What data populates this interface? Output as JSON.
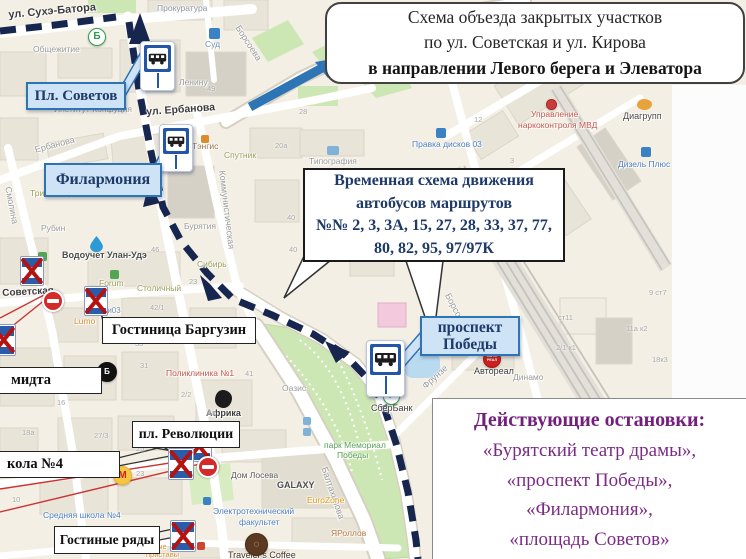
{
  "colors": {
    "route_navy": "#17264f",
    "detour_arrow_blue": "#2e75b6",
    "callout_blue_bg": "#cfe3f6",
    "callout_blue_border": "#2e74b5",
    "navy_text": "#1e3a68",
    "purple_text": "#7b2b85",
    "closed_x_red": "#b51212",
    "no_entry_red": "#d42a2a",
    "map_bg": "#f3efe4",
    "park_green": "#cde7b4"
  },
  "title_box": {
    "line1": "Схема объезда закрытых участков",
    "line2": "по ул. Советская и ул. Кирова",
    "line3": "в направлении Левого берега и Элеватора"
  },
  "routes_box": {
    "line1": "Временная схема движения",
    "line2": "автобусов маршрутов",
    "line3": "№№ 2, 3, 3А, 15, 27, 28, 33, 37, 77,",
    "line4": "80, 82, 95, 97/97К"
  },
  "active_stops_box": {
    "title": "Действующие остановки:",
    "items": [
      "«Бурятский театр драмы»,",
      "«проспект Победы»,",
      "«Филармония»,",
      "«площадь Советов»"
    ]
  },
  "stop_callouts": {
    "pl_sovetov": "Пл. Советов",
    "filarmonia": "Филармония",
    "pobedy_line1": "проспект",
    "pobedy_line2": "Победы"
  },
  "white_callouts": {
    "hotel": "Гостиница Баргузин",
    "revolution": "пл. Революции",
    "rows": "Гостиные ряды",
    "school": "кола №4",
    "shmidt": "мидта"
  },
  "map": {
    "streets": [
      {
        "t": "ул. Сухэ-Батора",
        "x": 8,
        "y": 10,
        "s": 11,
        "c": "#3c3c3c",
        "r": -5,
        "b": 1
      },
      {
        "t": "ул. Ербанова",
        "x": 146,
        "y": 107,
        "s": 10.5,
        "c": "#3c3c3c",
        "r": -4,
        "b": 1
      },
      {
        "t": "Ербанова",
        "x": 34,
        "y": 146,
        "s": 9,
        "c": "#9b9b9b",
        "r": -15,
        "b": 0
      },
      {
        "t": "Советская",
        "x": 2,
        "y": 289,
        "s": 10,
        "c": "#3c3c3c",
        "r": -3,
        "b": 1
      },
      {
        "t": "Смолина",
        "x": 12,
        "y": 186,
        "s": 9,
        "c": "#9b9b9b",
        "r": 79,
        "b": 0
      },
      {
        "t": "Коммунистическая",
        "x": 226,
        "y": 170,
        "s": 9,
        "c": "#9b9b9b",
        "r": 83,
        "b": 0
      },
      {
        "t": "Борсоева",
        "x": 241,
        "y": 24,
        "s": 9,
        "c": "#9b9b9b",
        "r": 57,
        "b": 0
      },
      {
        "t": "Борсоева",
        "x": 451,
        "y": 292,
        "s": 9,
        "c": "#9b9b9b",
        "r": 62,
        "b": 0
      },
      {
        "t": "Фрунзе",
        "x": 421,
        "y": 384,
        "s": 9,
        "c": "#9b9b9b",
        "r": -42,
        "b": 0
      },
      {
        "t": "Балтахинова",
        "x": 328,
        "y": 466,
        "s": 9,
        "c": "#9b9b9b",
        "r": 71,
        "b": 0
      }
    ],
    "pois": [
      {
        "t": "Прокуратура",
        "x": 157,
        "y": 4,
        "s": 8.5,
        "c": "#8a97a3",
        "r": 0,
        "b": 0
      },
      {
        "t": "Общежитие",
        "x": 33,
        "y": 45,
        "s": 8.5,
        "c": "#9b9b9b",
        "r": 0,
        "b": 0
      },
      {
        "t": "Суд",
        "x": 205,
        "y": 40,
        "s": 8.5,
        "c": "#6f8fae",
        "r": 0,
        "b": 0
      },
      {
        "t": "Ленину",
        "x": 179,
        "y": 78,
        "s": 8.5,
        "c": "#9b9b9b",
        "r": 0,
        "b": 0
      },
      {
        "t": "Институт Конфуция",
        "x": 54,
        "y": 105,
        "s": 8.5,
        "c": "#9b9b9b",
        "r": 0,
        "b": 0
      },
      {
        "t": "Тэнгис",
        "x": 192,
        "y": 142,
        "s": 8.5,
        "c": "#97764f",
        "r": 0,
        "b": 0
      },
      {
        "t": "Спутник",
        "x": 224,
        "y": 151,
        "s": 8.5,
        "c": "#9aa05a",
        "r": 0,
        "b": 0
      },
      {
        "t": "Типография",
        "x": 309,
        "y": 157,
        "s": 8.5,
        "c": "#9b9b9b",
        "r": 0,
        "b": 0
      },
      {
        "t": "Триста бариста",
        "x": 30,
        "y": 189,
        "s": 8.5,
        "c": "#9aa05a",
        "r": 0,
        "b": 0
      },
      {
        "t": "Рубин",
        "x": 41,
        "y": 224,
        "s": 8.5,
        "c": "#9b9b9b",
        "r": 0,
        "b": 0
      },
      {
        "t": "Водоучет Улан-Удэ",
        "x": 62,
        "y": 251,
        "s": 9,
        "c": "#4c4c4c",
        "r": 0,
        "b": 1
      },
      {
        "t": "Forum",
        "x": 99,
        "y": 279,
        "s": 8.5,
        "c": "#9aa05a",
        "r": 0,
        "b": 0
      },
      {
        "t": "Столичный",
        "x": 137,
        "y": 284,
        "s": 8.5,
        "c": "#9aa05a",
        "r": 0,
        "b": 0
      },
      {
        "t": "Lumo",
        "x": 74,
        "y": 317,
        "s": 8.5,
        "c": "#dc8f2e",
        "r": 0,
        "b": 0
      },
      {
        "t": "Эмчи03",
        "x": 92,
        "y": 307,
        "s": 8,
        "c": "#6f8fae",
        "r": 0,
        "b": 0
      },
      {
        "t": "Бурятия",
        "x": 184,
        "y": 222,
        "s": 8.5,
        "c": "#9b9b9b",
        "r": 0,
        "b": 0
      },
      {
        "t": "Сибирь",
        "x": 197,
        "y": 260,
        "s": 8.5,
        "c": "#9aa05a",
        "r": 0,
        "b": 0
      },
      {
        "t": "Поликлиника №1",
        "x": 166,
        "y": 369,
        "s": 8.5,
        "c": "#c2574b",
        "r": 0,
        "b": 0
      },
      {
        "t": "Африка",
        "x": 206,
        "y": 409,
        "s": 9,
        "c": "#3d3d3d",
        "r": 0,
        "b": 1
      },
      {
        "t": "Оазис",
        "x": 282,
        "y": 384,
        "s": 8.5,
        "c": "#9b9b9b",
        "r": 0,
        "b": 0
      },
      {
        "t": "парк Мемориал",
        "x": 324,
        "y": 441,
        "s": 8.5,
        "c": "#58a058",
        "r": 0,
        "b": 0
      },
      {
        "t": "Победы",
        "x": 337,
        "y": 451,
        "s": 8.5,
        "c": "#58a058",
        "r": 0,
        "b": 0
      },
      {
        "t": "Дом Лосева",
        "x": 231,
        "y": 471,
        "s": 8.5,
        "c": "#5a5a5a",
        "r": 0,
        "b": 0
      },
      {
        "t": "GALAXY",
        "x": 277,
        "y": 481,
        "s": 9,
        "c": "#4c4c4c",
        "r": 0,
        "b": 1
      },
      {
        "t": "EuroZone",
        "x": 307,
        "y": 496,
        "s": 8.5,
        "c": "#e09b10",
        "r": 0,
        "b": 0
      },
      {
        "t": "Электротехнический",
        "x": 213,
        "y": 507,
        "s": 8.5,
        "c": "#4d7fc0",
        "r": 0,
        "b": 0
      },
      {
        "t": "факультет",
        "x": 239,
        "y": 518,
        "s": 8.5,
        "c": "#4d7fc0",
        "r": 0,
        "b": 0
      },
      {
        "t": "ЯРоллов",
        "x": 331,
        "y": 529,
        "s": 8.5,
        "c": "#b5763c",
        "r": 0,
        "b": 0
      },
      {
        "t": "Traveler's Coffee",
        "x": 228,
        "y": 551,
        "s": 9,
        "c": "#463423",
        "r": 0,
        "b": 0
      },
      {
        "t": "СберБанк",
        "x": 371,
        "y": 404,
        "s": 9,
        "c": "#3d3d3d",
        "r": 0,
        "b": 0
      },
      {
        "t": "Автореал",
        "x": 474,
        "y": 367,
        "s": 9,
        "c": "#3d3d3d",
        "r": 0,
        "b": 0
      },
      {
        "t": "Динамо",
        "x": 513,
        "y": 373,
        "s": 8.5,
        "c": "#9b9b9b",
        "r": 0,
        "b": 0
      },
      {
        "t": "Управление",
        "x": 531,
        "y": 110,
        "s": 8.5,
        "c": "#c2574b",
        "r": 0,
        "b": 0
      },
      {
        "t": "наркоконтроля МВД",
        "x": 518,
        "y": 121,
        "s": 8.5,
        "c": "#c2574b",
        "r": 0,
        "b": 0
      },
      {
        "t": "Правка дисков 03",
        "x": 412,
        "y": 140,
        "s": 8.5,
        "c": "#4d7fc0",
        "r": 0,
        "b": 0
      },
      {
        "t": "Диагрупп",
        "x": 623,
        "y": 112,
        "s": 9,
        "c": "#4c4c4c",
        "r": 0,
        "b": 0
      },
      {
        "t": "Дизель Плюс",
        "x": 618,
        "y": 160,
        "s": 8.5,
        "c": "#4d7fc0",
        "r": 0,
        "b": 0
      },
      {
        "t": "Средняя школа №4",
        "x": 43,
        "y": 511,
        "s": 8.5,
        "c": "#4d7fc0",
        "r": 0,
        "b": 0
      },
      {
        "t": "ные",
        "x": 153,
        "y": 543,
        "s": 7.5,
        "c": "#dc8f2e",
        "r": 0,
        "b": 0
      },
      {
        "t": "приставы",
        "x": 146,
        "y": 551,
        "s": 7.5,
        "c": "#dc8f2e",
        "r": 0,
        "b": 0
      }
    ],
    "numbers": [
      {
        "t": "46",
        "x": 151,
        "y": 246
      },
      {
        "t": "23",
        "x": 189,
        "y": 278
      },
      {
        "t": "42/1",
        "x": 150,
        "y": 304
      },
      {
        "t": "33",
        "x": 135,
        "y": 340
      },
      {
        "t": "31",
        "x": 140,
        "y": 362
      },
      {
        "t": "2/2",
        "x": 181,
        "y": 391
      },
      {
        "t": "2а",
        "x": 207,
        "y": 409
      },
      {
        "t": "16",
        "x": 57,
        "y": 399
      },
      {
        "t": "18а",
        "x": 22,
        "y": 429
      },
      {
        "t": "27/3",
        "x": 94,
        "y": 432
      },
      {
        "t": "25",
        "x": 136,
        "y": 445
      },
      {
        "t": "22",
        "x": 89,
        "y": 470
      },
      {
        "t": "23",
        "x": 136,
        "y": 470
      },
      {
        "t": "10",
        "x": 12,
        "y": 496
      },
      {
        "t": "20а",
        "x": 275,
        "y": 142
      },
      {
        "t": "40",
        "x": 287,
        "y": 214
      },
      {
        "t": "40",
        "x": 289,
        "y": 246
      },
      {
        "t": "49",
        "x": 207,
        "y": 85
      },
      {
        "t": "28",
        "x": 299,
        "y": 108
      },
      {
        "t": "12",
        "x": 474,
        "y": 116
      },
      {
        "t": "3",
        "x": 510,
        "y": 157
      },
      {
        "t": "41",
        "x": 245,
        "y": 370
      },
      {
        "t": "9 ст7",
        "x": 649,
        "y": 289
      },
      {
        "t": "11а к2",
        "x": 626,
        "y": 325
      },
      {
        "t": "18к3",
        "x": 652,
        "y": 356
      },
      {
        "t": "2/1 к1",
        "x": 556,
        "y": 344
      },
      {
        "t": "ст11",
        "x": 558,
        "y": 314
      }
    ]
  },
  "icons": [
    {
      "type": "droplet",
      "name": "water-meter-icon",
      "x": 90,
      "y": 236
    },
    {
      "type": "circle",
      "name": "b-station-icon",
      "x": 88,
      "y": 28,
      "d": 16,
      "bg": "#ffffff",
      "fg": "#2e9e4f",
      "t": "Б",
      "fs": 10,
      "bd": "#2e9e4f"
    },
    {
      "type": "circle",
      "name": "magnit-icon",
      "x": 113,
      "y": 466,
      "d": 17,
      "bg": "#f6c643",
      "fg": "#cc2222",
      "t": "М",
      "fs": 10,
      "bd": "#e8b52e"
    },
    {
      "type": "circle",
      "name": "buuza-cafe-icon",
      "x": 97,
      "y": 362,
      "d": 18,
      "bg": "#111111",
      "fg": "#ffffff",
      "t": "Б",
      "fs": 8,
      "bd": "#111111"
    },
    {
      "type": "circle",
      "name": "sberbank-icon",
      "x": 383,
      "y": 388,
      "d": 15,
      "bg": "#ffffff",
      "fg": "#2e9e4f",
      "t": "✓",
      "fs": 9,
      "bd": "#2e9e4f"
    },
    {
      "type": "circle",
      "name": "avtoreal-icon",
      "x": 483,
      "y": 350,
      "d": 16,
      "bg": "#cc1f1f",
      "fg": "#ffffff",
      "t": "АВТО\nРЕАЛ",
      "fs": 3.6,
      "bd": "#a81515"
    },
    {
      "type": "circle",
      "name": "coffee-icon",
      "x": 245,
      "y": 533,
      "d": 21,
      "bg": "#5b3a21",
      "fg": "#e8d9b0",
      "t": "◌",
      "fs": 10,
      "bd": "#3f2a15"
    },
    {
      "type": "blob",
      "name": "diagrupp-icon",
      "x": 637,
      "y": 99,
      "w": 15,
      "h": 11,
      "bg": "#e8a33d"
    },
    {
      "type": "dot",
      "name": "court-icon",
      "x": 209,
      "y": 28,
      "w": 11,
      "h": 11,
      "bg": "#3b82c4"
    },
    {
      "type": "dot",
      "name": "print-house-icon",
      "x": 327,
      "y": 146,
      "w": 12,
      "h": 9,
      "bg": "#7fb2d8"
    },
    {
      "type": "dot",
      "name": "wheel-repair-icon",
      "x": 436,
      "y": 128,
      "w": 10,
      "h": 10,
      "bg": "#3b82c4"
    },
    {
      "type": "dot",
      "name": "diesel-plus-icon",
      "x": 641,
      "y": 147,
      "w": 10,
      "h": 10,
      "bg": "#3b82c4"
    },
    {
      "type": "circle",
      "name": "mvd-pin-icon",
      "x": 546,
      "y": 99,
      "d": 9,
      "bg": "#cc3b3b",
      "fg": "#ffffff",
      "t": "",
      "fs": 4,
      "bd": "#a82828"
    },
    {
      "type": "dot",
      "name": "shop-icon",
      "x": 197,
      "y": 542,
      "w": 8,
      "h": 8,
      "bg": "#cc4433"
    },
    {
      "type": "dot",
      "name": "forum-icon",
      "x": 110,
      "y": 270,
      "w": 9,
      "h": 9,
      "bg": "#52a552"
    },
    {
      "type": "dot",
      "name": "market-cart-icon",
      "x": 38,
      "y": 252,
      "w": 9,
      "h": 9,
      "bg": "#52a552"
    },
    {
      "type": "dot",
      "name": "tengis-icon",
      "x": 201,
      "y": 135,
      "w": 8,
      "h": 8,
      "bg": "#e08a2e"
    },
    {
      "type": "dot",
      "name": "faculty-icon",
      "x": 203,
      "y": 497,
      "w": 8,
      "h": 8,
      "bg": "#3b82c4"
    },
    {
      "type": "dot",
      "name": "park-info-icon",
      "x": 303,
      "y": 417,
      "w": 8,
      "h": 8,
      "bg": "#7fb2d8"
    },
    {
      "type": "dot",
      "name": "park-info-icon",
      "x": 303,
      "y": 428,
      "w": 8,
      "h": 8,
      "bg": "#7fb2d8"
    },
    {
      "type": "blob",
      "name": "africa-icon",
      "x": 215,
      "y": 390,
      "w": 17,
      "h": 18,
      "bg": "#1c1c1c"
    }
  ],
  "bus_stops": [
    {
      "name": "bus-stop-pl-sovetov",
      "x": 140,
      "y": 41,
      "w": 33,
      "h": 48
    },
    {
      "name": "bus-stop-filarmonia",
      "x": 159,
      "y": 124,
      "w": 32,
      "h": 46
    },
    {
      "name": "bus-stop-prospekt-pobedy",
      "x": 366,
      "y": 340,
      "w": 37,
      "h": 55
    }
  ],
  "closed_stops": [
    {
      "x": 20,
      "y": 256,
      "w": 24,
      "h": 30
    },
    {
      "x": 84,
      "y": 286,
      "w": 24,
      "h": 30
    },
    {
      "x": -8,
      "y": 324,
      "w": 24,
      "h": 32
    },
    {
      "x": 186,
      "y": 430,
      "w": 26,
      "h": 32
    },
    {
      "x": 168,
      "y": 448,
      "w": 26,
      "h": 32
    },
    {
      "x": 170,
      "y": 520,
      "w": 26,
      "h": 32
    }
  ],
  "no_entry": [
    {
      "x": 42,
      "y": 290
    },
    {
      "x": 197,
      "y": 456
    }
  ]
}
